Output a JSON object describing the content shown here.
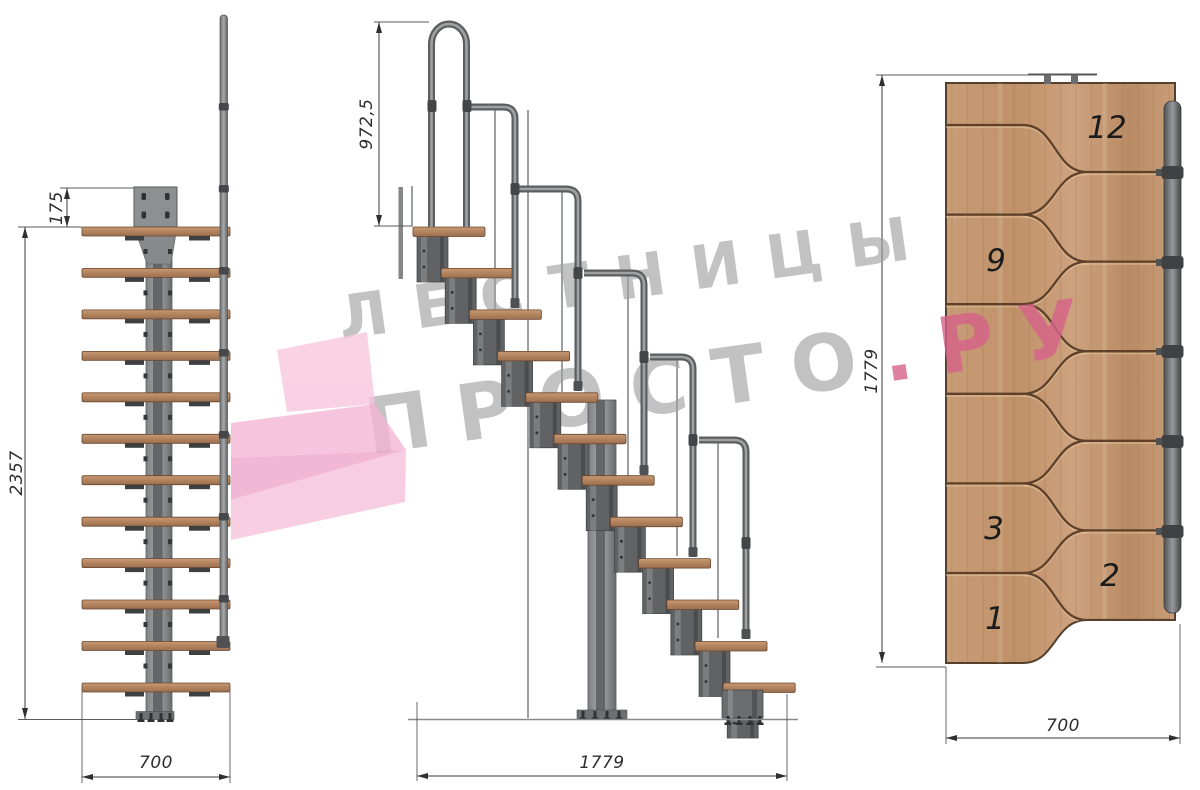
{
  "watermark": {
    "line1": "ЛЕСТНИЦЫ",
    "line2_gray": "ПРОСТО",
    "line2_pink": ".РУ",
    "gray_color": "#9c9c9c",
    "pink_color": "#d6628a"
  },
  "front_view": {
    "dim_plate_offset": "175",
    "dim_total_height": "2357",
    "dim_width": "700",
    "steps_count": 12
  },
  "side_view": {
    "dim_handrail_height": "972,5",
    "dim_total_run": "1779",
    "steps_count": 12
  },
  "plan_view": {
    "dim_total_run": "1779",
    "dim_width": "700",
    "step_labels": [
      "12",
      "9",
      "3",
      "2",
      "1"
    ]
  },
  "colors": {
    "wood_light": "#c89d78",
    "wood_dark": "#9a7051",
    "groove": "#5e4128",
    "metal": "#8f9193",
    "metal_dark": "#5a5c5e",
    "dimension": "#2d2d2d",
    "logo_pink_light": "#f7c6dd",
    "logo_pink_mid": "#f2abd0"
  }
}
